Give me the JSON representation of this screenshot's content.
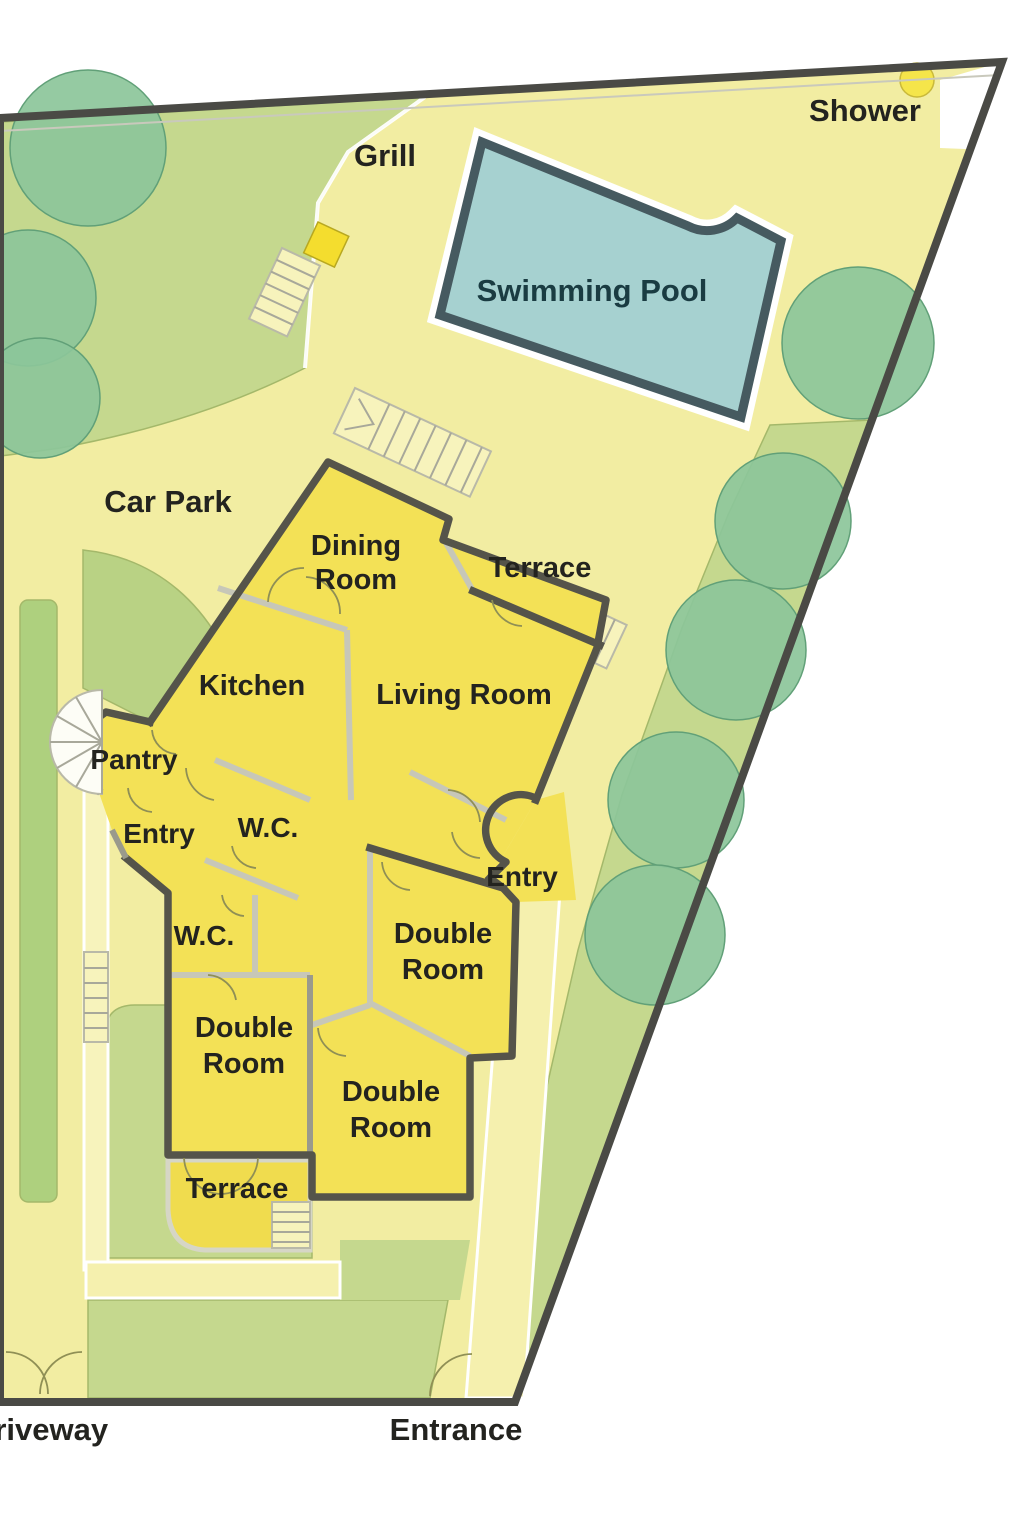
{
  "plan_title": "Villa site and floor plan",
  "colors": {
    "outside": "#ffffff",
    "base_paving": "#f2eda2",
    "lawn": "#c5d88e",
    "lawn_dark": "#b9d284",
    "hedge": "#aed07e",
    "tree": "#8cc69a",
    "tree_stroke": "#61a078",
    "pool": "#a6d1d0",
    "pool_wall": "#465a60",
    "room": "#f3e156",
    "terrace": "#f0dc4e",
    "wall_dark": "#55544a",
    "wall_light": "#c7c7b8",
    "path": "#f5f0ae",
    "boundary": "#4a4a45",
    "grill": "#f4dd2e",
    "shower_spot": "#f5e54a",
    "text": "#23231f",
    "pool_text": "#1a3c42"
  },
  "labels": [
    {
      "id": "grill",
      "text": "Grill"
    },
    {
      "id": "shower",
      "text": "Shower"
    },
    {
      "id": "swimming-pool",
      "text": "Swimming Pool"
    },
    {
      "id": "car-park",
      "text": "Car Park"
    },
    {
      "id": "dining-room-line1",
      "text": "Dining"
    },
    {
      "id": "dining-room-line2",
      "text": "Room"
    },
    {
      "id": "terrace-upper",
      "text": "Terrace"
    },
    {
      "id": "kitchen",
      "text": "Kitchen"
    },
    {
      "id": "living-room",
      "text": "Living Room"
    },
    {
      "id": "pantry",
      "text": "Pantry"
    },
    {
      "id": "entry-left",
      "text": "Entry"
    },
    {
      "id": "wc-upper",
      "text": "W.C."
    },
    {
      "id": "entry-right",
      "text": "Entry"
    },
    {
      "id": "double-room-right-line1",
      "text": "Double"
    },
    {
      "id": "double-room-right-line2",
      "text": "Room"
    },
    {
      "id": "wc-lower",
      "text": "W.C."
    },
    {
      "id": "double-room-left-line1",
      "text": "Double"
    },
    {
      "id": "double-room-left-line2",
      "text": "Room"
    },
    {
      "id": "double-room-bottom-line1",
      "text": "Double"
    },
    {
      "id": "double-room-bottom-line2",
      "text": "Room"
    },
    {
      "id": "terrace-lower",
      "text": "Terrace"
    },
    {
      "id": "driveway",
      "text": "Driveway"
    },
    {
      "id": "entrance",
      "text": "Entrance"
    }
  ],
  "features": {
    "rooms": [
      "Dining Room",
      "Terrace (upper)",
      "Kitchen",
      "Living Room",
      "Pantry",
      "Entry (left)",
      "W.C. (upper)",
      "Entry (right)",
      "Double Room (right)",
      "W.C. (lower)",
      "Double Room (left)",
      "Double Room (bottom)",
      "Terrace (lower)"
    ],
    "outdoor": [
      "Swimming Pool",
      "Pool deck",
      "Grill",
      "Shower",
      "Car Park",
      "Driveway",
      "Entrance",
      "Hedge",
      "Lawn"
    ],
    "tree_count": 8,
    "trees": [
      {
        "cx": 88,
        "cy": 148,
        "r": 78
      },
      {
        "cx": 28,
        "cy": 298,
        "r": 68
      },
      {
        "cx": 40,
        "cy": 398,
        "r": 60
      },
      {
        "cx": 858,
        "cy": 343,
        "r": 76
      },
      {
        "cx": 783,
        "cy": 521,
        "r": 68
      },
      {
        "cx": 736,
        "cy": 650,
        "r": 70
      },
      {
        "cx": 676,
        "cy": 800,
        "r": 68
      },
      {
        "cx": 655,
        "cy": 935,
        "r": 70
      }
    ],
    "gates": [
      "driveway-gate",
      "entrance-gate"
    ],
    "stair_count": 6
  }
}
